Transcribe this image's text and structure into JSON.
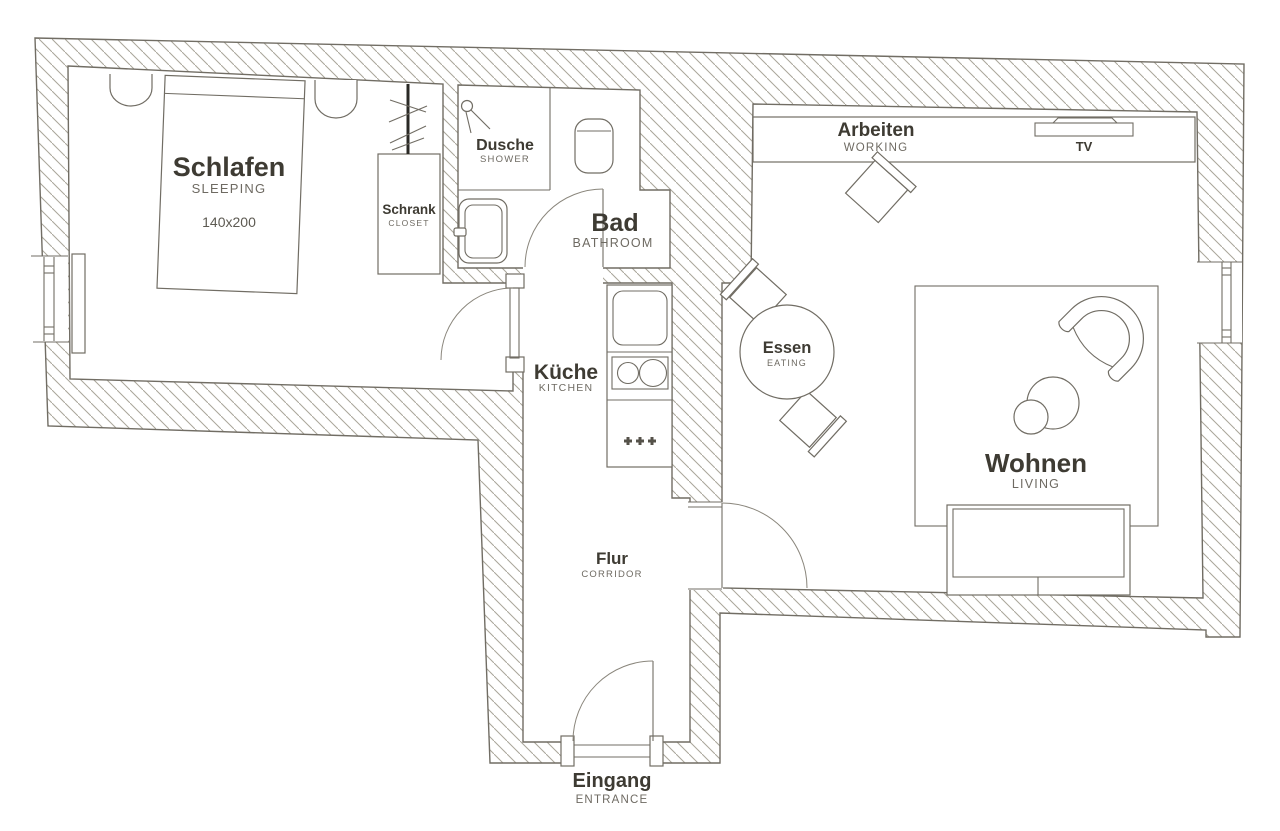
{
  "title": "Apartment floor plan",
  "colors": {
    "wall_line": "#716d64",
    "hatch_line": "#a9a59a",
    "label_dark": "#3e3b33",
    "label_light": "#6e6a62",
    "background": "#ffffff"
  },
  "rooms": {
    "sleeping": {
      "de": "Schlafen",
      "en": "SLEEPING",
      "size": "140x200"
    },
    "closet": {
      "de": "Schrank",
      "en": "CLOSET"
    },
    "shower": {
      "de": "Dusche",
      "en": "SHOWER"
    },
    "bathroom": {
      "de": "Bad",
      "en": "BATHROOM"
    },
    "kitchen": {
      "de": "Küche",
      "en": "KITCHEN"
    },
    "corridor": {
      "de": "Flur",
      "en": "CORRIDOR"
    },
    "entrance": {
      "de": "Eingang",
      "en": "ENTRANCE"
    },
    "working": {
      "de": "Arbeiten",
      "en": "WORKING"
    },
    "eating": {
      "de": "Essen",
      "en": "EATING"
    },
    "living": {
      "de": "Wohnen",
      "en": "LIVING"
    }
  },
  "furniture": {
    "tv_label": "TV"
  }
}
